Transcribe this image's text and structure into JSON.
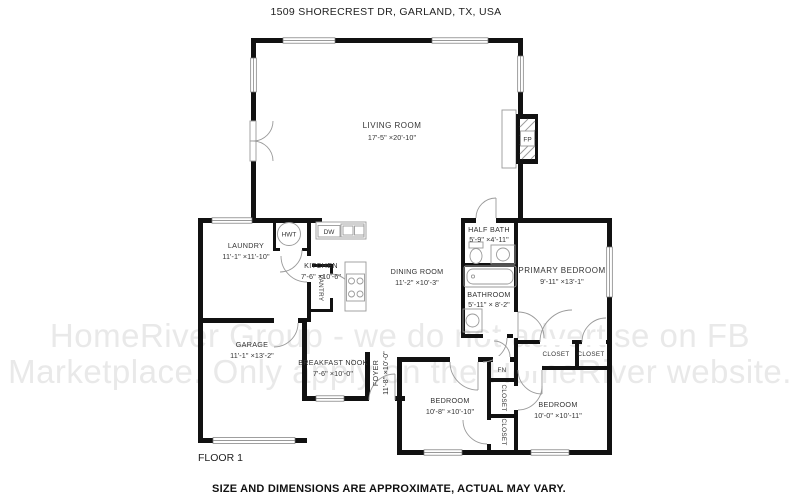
{
  "page": {
    "title_address": "1509 SHORECREST DR, GARLAND, TX, USA",
    "floor_label": "FLOOR 1",
    "disclaimer": "SIZE AND DIMENSIONS ARE APPROXIMATE, ACTUAL MAY VARY."
  },
  "watermark": {
    "line1": "HomeRiver Group - we do not advertise on FB",
    "line2": "Marketplace. Only apply on the HomeRiver website."
  },
  "rooms": {
    "living_room": {
      "name": "LIVING ROOM",
      "dims": "17'-5\" ×20'-10\""
    },
    "laundry": {
      "name": "LAUNDRY",
      "dims": "11'-1\" ×11'-10\""
    },
    "kitchen": {
      "name": "KITCHEN",
      "dims": "7'-6\" ×10'-6\""
    },
    "dining_room": {
      "name": "DINING ROOM",
      "dims": "11'-2\" ×10'-3\""
    },
    "half_bath": {
      "name": "HALF BATH",
      "dims": "5'-9\" ×4'-11\""
    },
    "bathroom": {
      "name": "BATHROOM",
      "dims": "5'-11\" × 8'-2\""
    },
    "primary_bedroom": {
      "name": "PRIMARY BEDROOM",
      "dims": "9'-11\" ×13'-1\""
    },
    "garage": {
      "name": "GARAGE",
      "dims": "11'-1\" ×13'-2\""
    },
    "breakfast_nook": {
      "name": "BREAKFAST NOOK",
      "dims": "7'-6\" ×10'-0\""
    },
    "foyer": {
      "name": "FOYER",
      "dims": "11'-8\" ×10'-0\""
    },
    "bedroom_left": {
      "name": "BEDROOM",
      "dims": "10'-8\" ×10'-10\""
    },
    "bedroom_right": {
      "name": "BEDROOM",
      "dims": "10'-0\" ×10'-11\""
    }
  },
  "labels": {
    "closet": "CLOSET",
    "pantry": "PANTRY",
    "hwt": "HWT",
    "dw": "DW",
    "fp": "FP",
    "fn": "FN"
  },
  "colors": {
    "wall": "#111111",
    "fixture_line": "#9a9a9a",
    "label_text": "#333333",
    "watermark": "#e9e9e9",
    "background": "#ffffff"
  }
}
